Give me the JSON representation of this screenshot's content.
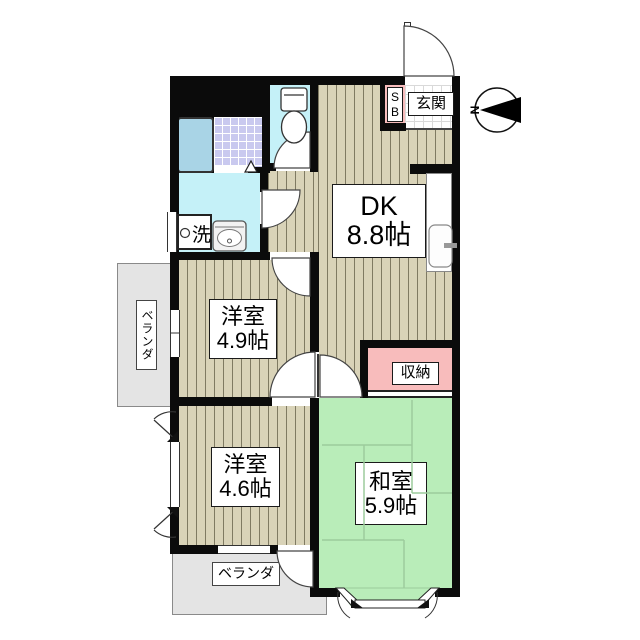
{
  "colors": {
    "wall": "#0b0b0b",
    "wood": "#d9d3b8",
    "wood-line": "#7f7a62",
    "tatami": "#b9edb9",
    "tatami-line": "#9ccb9c",
    "water": "#c5f1f8",
    "pink": "#f8bcbc",
    "tub": "#a9d4e6",
    "tile": "#c9c9ef",
    "veranda": "#e4e4e4"
  },
  "compass": {
    "north_label": "N"
  },
  "rooms": {
    "dk": {
      "name": "DK",
      "size": "8.8帖"
    },
    "youshitsu49": {
      "name": "洋室",
      "size": "4.9帖"
    },
    "youshitsu46": {
      "name": "洋室",
      "size": "4.6帖"
    },
    "washitsu": {
      "name": "和室",
      "size": "5.9帖"
    }
  },
  "labels": {
    "closet": "収納",
    "entrance": "玄関",
    "shoebox_s": "S",
    "shoebox_b": "B",
    "laundry": "洗",
    "balcony_left": "ベランダ",
    "balcony_bottom": "ベランダ"
  }
}
